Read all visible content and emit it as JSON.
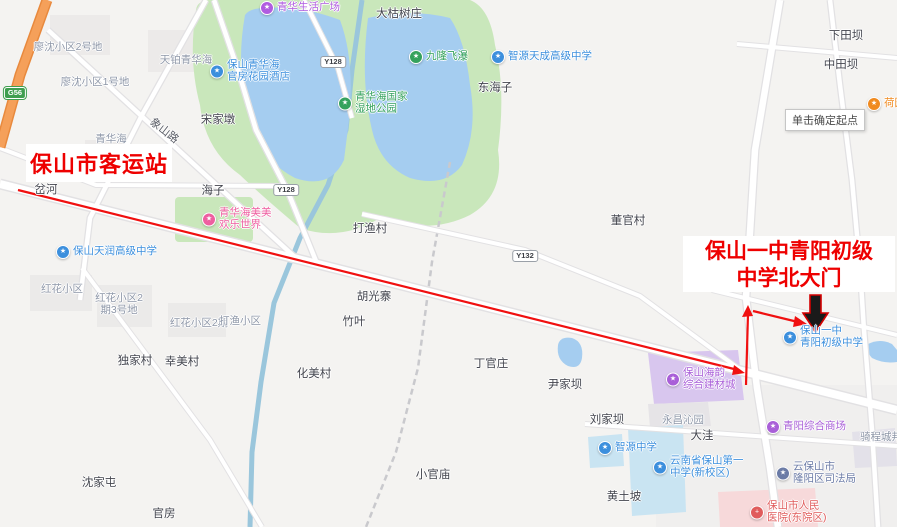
{
  "annotations": {
    "start_label": "保山市客运站",
    "dest_label_line1": "保山一中青阳初级",
    "dest_label_line2": "中学北大门",
    "tooltip": "单击确定起点"
  },
  "colors": {
    "annotation_red": "#ee0000",
    "route_red": "#f01010",
    "gate_arrow_fill": "#1a1a1a",
    "water": "#a5cdf0",
    "park": "#c9e7bb",
    "poi_blue": "#3c8fdd",
    "poi_green": "#35a25d",
    "poi_pink": "#ea66a8",
    "poi_purple": "#a95fd8",
    "poi_orange": "#f08a1f",
    "poi_red": "#e05c5c",
    "poi_slate": "#6b7ba6",
    "highway_orange": "#f5a05a"
  },
  "map": {
    "labels": [
      {
        "n": "label-liaoshen-block2",
        "t": "area",
        "text": "廖沈小区2号地",
        "x": 68,
        "y": 47
      },
      {
        "n": "label-liaoshen-block1",
        "t": "area",
        "text": "廖沈小区1号地",
        "x": 95,
        "y": 82
      },
      {
        "n": "label-tianbo-qinghuahai",
        "t": "area",
        "text": "天铂青华海",
        "x": 186,
        "y": 60
      },
      {
        "n": "label-qinghuahai-area",
        "t": "area",
        "text": "青华海",
        "x": 111,
        "y": 139
      },
      {
        "n": "poi-qinghua-life-plaza",
        "t": "poi",
        "icon": "shopping-plaza-icon",
        "c": "#b05ce0",
        "lines": [
          "青华生活广场"
        ],
        "x": 267,
        "y": 8
      },
      {
        "n": "poi-baoshan-qinghuahai-hotel",
        "t": "poi",
        "icon": "hotel-icon",
        "c": "#3c8fdd",
        "lines": [
          "保山青华海",
          "官房花园酒店"
        ],
        "x": 217,
        "y": 71
      },
      {
        "n": "label-dakushuzhuang",
        "t": "dark",
        "text": "大枯树庄",
        "x": 399,
        "y": 14
      },
      {
        "n": "poi-jiulong-waterfall",
        "t": "poi",
        "icon": "scenic-icon",
        "c": "#35a25d",
        "lines": [
          "九隆飞瀑"
        ],
        "x": 416,
        "y": 57
      },
      {
        "n": "poi-zhiyuan-tiancheng-school",
        "t": "poi",
        "icon": "school-icon",
        "c": "#3c8fdd",
        "lines": [
          "智源天成高级中学"
        ],
        "x": 498,
        "y": 57
      },
      {
        "n": "label-donghaizi",
        "t": "dark",
        "text": "东海子",
        "x": 495,
        "y": 88
      },
      {
        "n": "label-xiatianba",
        "t": "dark",
        "text": "下田坝",
        "x": 846,
        "y": 36
      },
      {
        "n": "label-zhongtianba",
        "t": "dark",
        "text": "中田坝",
        "x": 841,
        "y": 65
      },
      {
        "n": "poi-orange-clipped",
        "t": "poi",
        "icon": "poi-icon",
        "c": "#f08a1f",
        "lines": [
          "荷园"
        ],
        "x": 874,
        "y": 104
      },
      {
        "n": "label-songjiadun",
        "t": "dark",
        "text": "宋家墩",
        "x": 218,
        "y": 120
      },
      {
        "n": "label-xiangshan-road",
        "t": "road",
        "text": "象山路",
        "x": 164,
        "y": 131,
        "rot": 38
      },
      {
        "n": "badge-g56",
        "t": "badgegreen",
        "text": "G56",
        "x": 15,
        "y": 93
      },
      {
        "n": "badge-y128-north",
        "t": "badge",
        "text": "Y128",
        "x": 333,
        "y": 62
      },
      {
        "n": "badge-y128-south",
        "t": "badge",
        "text": "Y128",
        "x": 286,
        "y": 190
      },
      {
        "n": "badge-y132",
        "t": "badge",
        "text": "Y132",
        "x": 525,
        "y": 256
      },
      {
        "n": "poi-wetland-park",
        "t": "poi",
        "icon": "park-icon",
        "c": "#35a25d",
        "lines": [
          "青华海国家",
          "湿地公园"
        ],
        "x": 345,
        "y": 103
      },
      {
        "n": "label-chahe",
        "t": "dark",
        "text": "岔河",
        "x": 46,
        "y": 190
      },
      {
        "n": "label-haizi",
        "t": "dark",
        "text": "海子",
        "x": 213,
        "y": 191
      },
      {
        "n": "poi-meimei-funworld",
        "t": "poi",
        "icon": "amusement-icon",
        "c": "#ee5fa0",
        "lines": [
          "青华海美美",
          "欢乐世界"
        ],
        "x": 209,
        "y": 219
      },
      {
        "n": "label-dayucun",
        "t": "dark",
        "text": "打渔村",
        "x": 370,
        "y": 229
      },
      {
        "n": "label-dongguancun",
        "t": "dark",
        "text": "董官村",
        "x": 628,
        "y": 221
      },
      {
        "n": "poi-tianrun-school",
        "t": "poi",
        "icon": "school-icon",
        "c": "#3c8fdd",
        "lines": [
          "保山天润高级中学"
        ],
        "x": 63,
        "y": 252
      },
      {
        "n": "label-honghua-block",
        "t": "area",
        "text": "红花小区",
        "x": 62,
        "y": 289
      },
      {
        "n": "label-honghua-block2-3",
        "t": "area",
        "lines": [
          "红花小区2",
          "期3号地"
        ],
        "x": 119,
        "y": 304
      },
      {
        "n": "label-honghua-block2",
        "t": "area",
        "text": "红花小区2期",
        "x": 199,
        "y": 323
      },
      {
        "n": "label-dayu-block",
        "t": "area",
        "text": "打渔小区",
        "x": 240,
        "y": 321
      },
      {
        "n": "label-huguangzhai",
        "t": "dark",
        "text": "胡光寨",
        "x": 374,
        "y": 297
      },
      {
        "n": "label-zhuye",
        "t": "dark",
        "text": "竹叶",
        "x": 354,
        "y": 322
      },
      {
        "n": "label-dujiacun",
        "t": "dark",
        "text": "独家村",
        "x": 135,
        "y": 361
      },
      {
        "n": "label-xingmeicun",
        "t": "dark",
        "text": "幸美村",
        "x": 182,
        "y": 362
      },
      {
        "n": "label-huameicun",
        "t": "dark",
        "text": "化美村",
        "x": 314,
        "y": 374
      },
      {
        "n": "label-dingguanzhuang",
        "t": "dark",
        "text": "丁官庄",
        "x": 491,
        "y": 364
      },
      {
        "n": "label-yinjiaba",
        "t": "dark",
        "text": "尹家坝",
        "x": 565,
        "y": 385
      },
      {
        "n": "poi-haiyun-building-city",
        "t": "poi",
        "icon": "market-icon",
        "c": "#a95fd8",
        "lines": [
          "保山海韵",
          "综合建材城"
        ],
        "x": 673,
        "y": 379
      },
      {
        "n": "poi-baoshan-yizhong-qingyang",
        "t": "poi",
        "icon": "school-icon",
        "c": "#3c8fdd",
        "lines": [
          "保山一中",
          "青阳初级中学"
        ],
        "x": 790,
        "y": 337
      },
      {
        "n": "label-liujiaba",
        "t": "dark",
        "text": "刘家坝",
        "x": 607,
        "y": 420
      },
      {
        "n": "label-yongchang-qinyuan",
        "t": "area",
        "text": "永昌沁园",
        "x": 683,
        "y": 420
      },
      {
        "n": "label-dawa",
        "t": "dark",
        "text": "大洼",
        "x": 702,
        "y": 436
      },
      {
        "n": "poi-qingyang-mall",
        "t": "poi",
        "icon": "shopping-mall-icon",
        "c": "#a95fd8",
        "lines": [
          "青阳综合商场"
        ],
        "x": 773,
        "y": 427
      },
      {
        "n": "poi-zhiyuan-middle-school",
        "t": "poi",
        "icon": "school-icon",
        "c": "#3c8fdd",
        "lines": [
          "智源中学"
        ],
        "x": 605,
        "y": 448
      },
      {
        "n": "poi-baoshan-no1-school",
        "t": "poi",
        "icon": "school-icon",
        "c": "#3c8fdd",
        "lines": [
          "云南省保山第一",
          "中学(新校区)"
        ],
        "x": 660,
        "y": 467
      },
      {
        "n": "poi-longyang-justice-bureau",
        "t": "poi",
        "icon": "government-icon",
        "c": "#6b7ba6",
        "lines": [
          "云保山市",
          "隆阳区司法局"
        ],
        "x": 783,
        "y": 473
      },
      {
        "n": "label-qichengchengbang",
        "t": "area",
        "text": "骑程城邦",
        "x": 881,
        "y": 437
      },
      {
        "n": "label-huangtupo",
        "t": "dark",
        "text": "黄土坡",
        "x": 624,
        "y": 497
      },
      {
        "n": "poi-peoples-hospital",
        "t": "poi",
        "icon": "hospital-icon",
        "c": "#e05c5c",
        "g": "+",
        "lines": [
          "保山市人民",
          "医院(东院区)"
        ],
        "x": 757,
        "y": 512
      },
      {
        "n": "label-xiaoguanmiao",
        "t": "dark",
        "text": "小官庙",
        "x": 433,
        "y": 475
      },
      {
        "n": "label-shenjiatun",
        "t": "dark",
        "text": "沈家屯",
        "x": 99,
        "y": 483
      },
      {
        "n": "label-guanfang",
        "t": "dark",
        "text": "官房",
        "x": 164,
        "y": 514
      }
    ]
  }
}
